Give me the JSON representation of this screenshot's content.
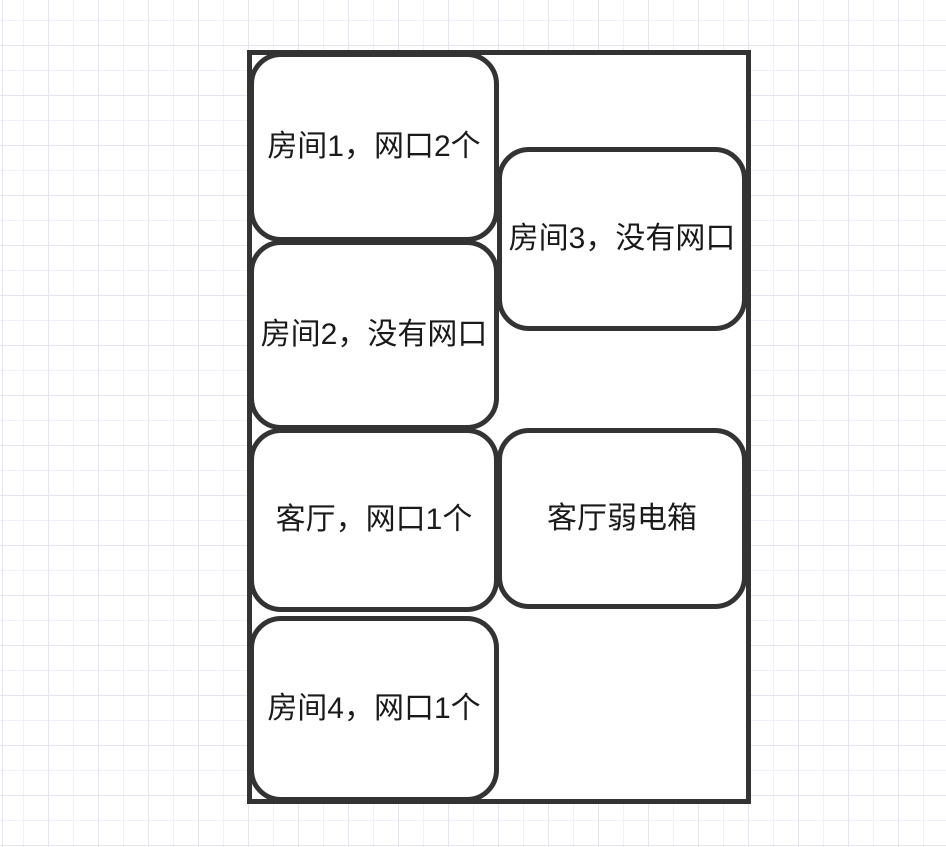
{
  "canvas": {
    "background": "#ffffff",
    "grid_minor_color": "#f1f0fa",
    "grid_major_color": "#e6e4f4",
    "grid_minor_spacing_px": 25,
    "grid_major_spacing_px": 50
  },
  "shapes": {
    "stroke_color": "#333333",
    "fill_color": "#ffffff",
    "text_color": "#1a1a1a",
    "outline": {
      "id": "apartment-outline"
    },
    "rooms": [
      {
        "id": "room1",
        "label": "房间1，网口2个"
      },
      {
        "id": "room2",
        "label": "房间2，没有网口"
      },
      {
        "id": "room3",
        "label": "房间3，没有网口"
      },
      {
        "id": "living-room",
        "label": "客厅，网口1个"
      },
      {
        "id": "weak-current-box",
        "label": "客厅弱电箱"
      },
      {
        "id": "room4",
        "label": "房间4，网口1个"
      }
    ]
  }
}
